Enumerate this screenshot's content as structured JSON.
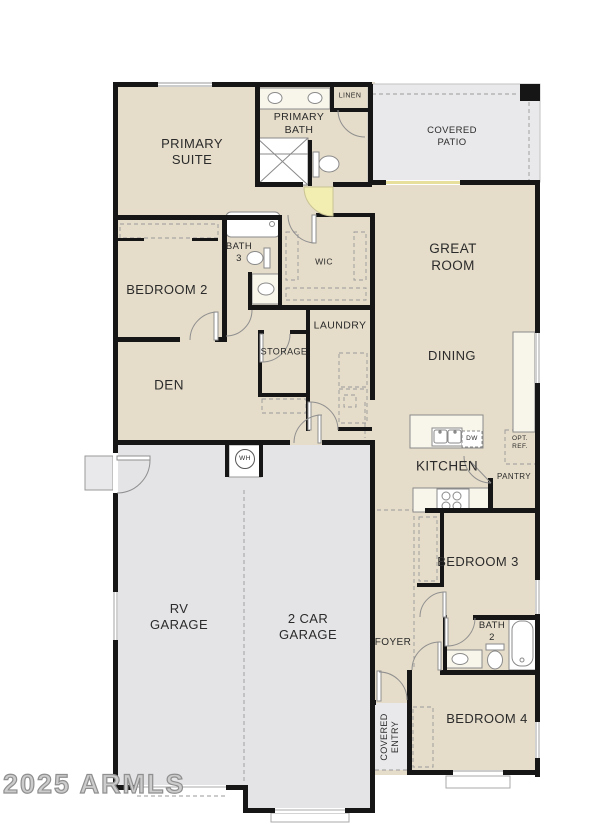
{
  "watermark": "2025 ARMLS",
  "colors": {
    "floor_tan": "#e5dcc9",
    "garage_gray": "#e4e4e7",
    "patio_gray": "#e9e9eb",
    "wall_black": "#161616",
    "entry_door_yellow": "#f2edb0",
    "fixture_cream": "#f8f5ea"
  },
  "rooms": {
    "primary_suite": {
      "line1": "PRIMARY",
      "line2": "SUITE"
    },
    "primary_bath": {
      "line1": "PRIMARY",
      "line2": "BATH"
    },
    "linen": "LINEN",
    "covered_patio": {
      "line1": "COVERED",
      "line2": "PATIO"
    },
    "great_room": {
      "line1": "GREAT",
      "line2": "ROOM"
    },
    "bedroom2": "BEDROOM 2",
    "bath3": {
      "line1": "BATH",
      "line2": "3"
    },
    "wic": "WIC",
    "laundry": "LAUNDRY",
    "storage": "STORAGE",
    "den": "DEN",
    "dining": "DINING",
    "kitchen": "KITCHEN",
    "pantry": "PANTRY",
    "opt_ref": {
      "line1": "OPT.",
      "line2": "REF."
    },
    "dw": "DW",
    "wh": "WH",
    "rv_garage": {
      "line1": "RV",
      "line2": "GARAGE"
    },
    "two_car_garage": {
      "line1": "2 CAR",
      "line2": "GARAGE"
    },
    "foyer": "FOYER",
    "bedroom3": "BEDROOM 3",
    "bath2": {
      "line1": "BATH",
      "line2": "2"
    },
    "bedroom4": "BEDROOM 4",
    "covered_entry": {
      "line1": "COVERED",
      "line2": "ENTRY"
    }
  }
}
